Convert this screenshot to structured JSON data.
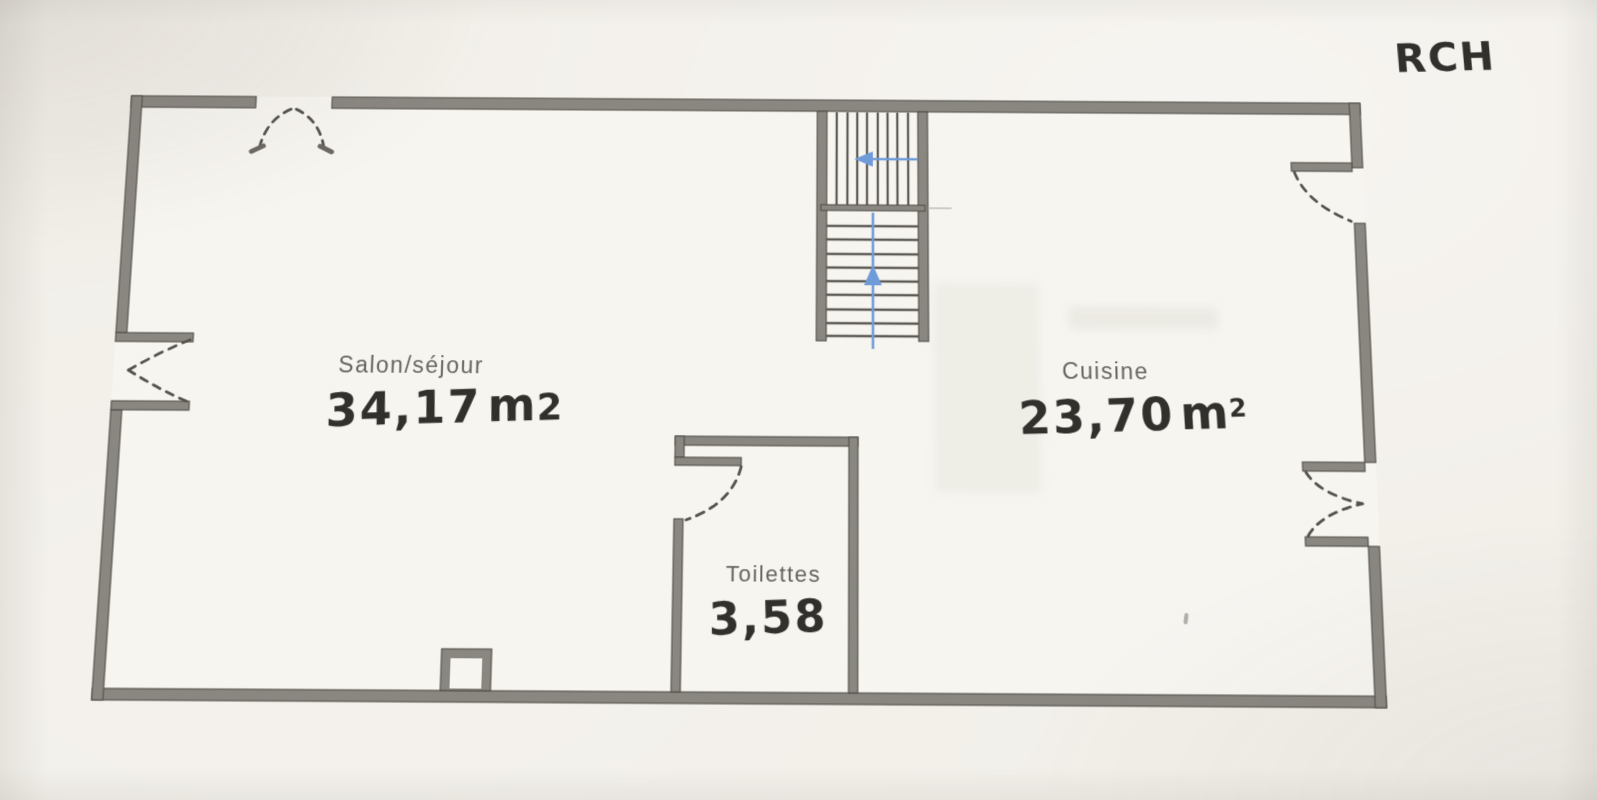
{
  "photo": {
    "floor_annotation": "RCH"
  },
  "rooms": [
    {
      "name": "Salon/séjour",
      "area": "34,17",
      "unit_base": "m",
      "unit_exp": "2"
    },
    {
      "name": "Cuisine",
      "area": "23,70",
      "unit_base": "m",
      "unit_exp": "2"
    },
    {
      "name": "Toilettes",
      "area": "3,58",
      "unit_base": "",
      "unit_exp": ""
    }
  ],
  "stairs": {
    "lower_flight_arrow_icon": "arrow-up",
    "upper_flight_arrow_icon": "arrow-left"
  },
  "colors": {
    "paper": "#f2efe9",
    "interior": "#f7f5f0",
    "wall_fill": "#8a8680",
    "wall_edge": "#53504b",
    "door_dash": "#55524c",
    "arrow_blue": "#6f9bd9",
    "handwriting_ink": "#32302c",
    "printed_label": "#67645e"
  }
}
